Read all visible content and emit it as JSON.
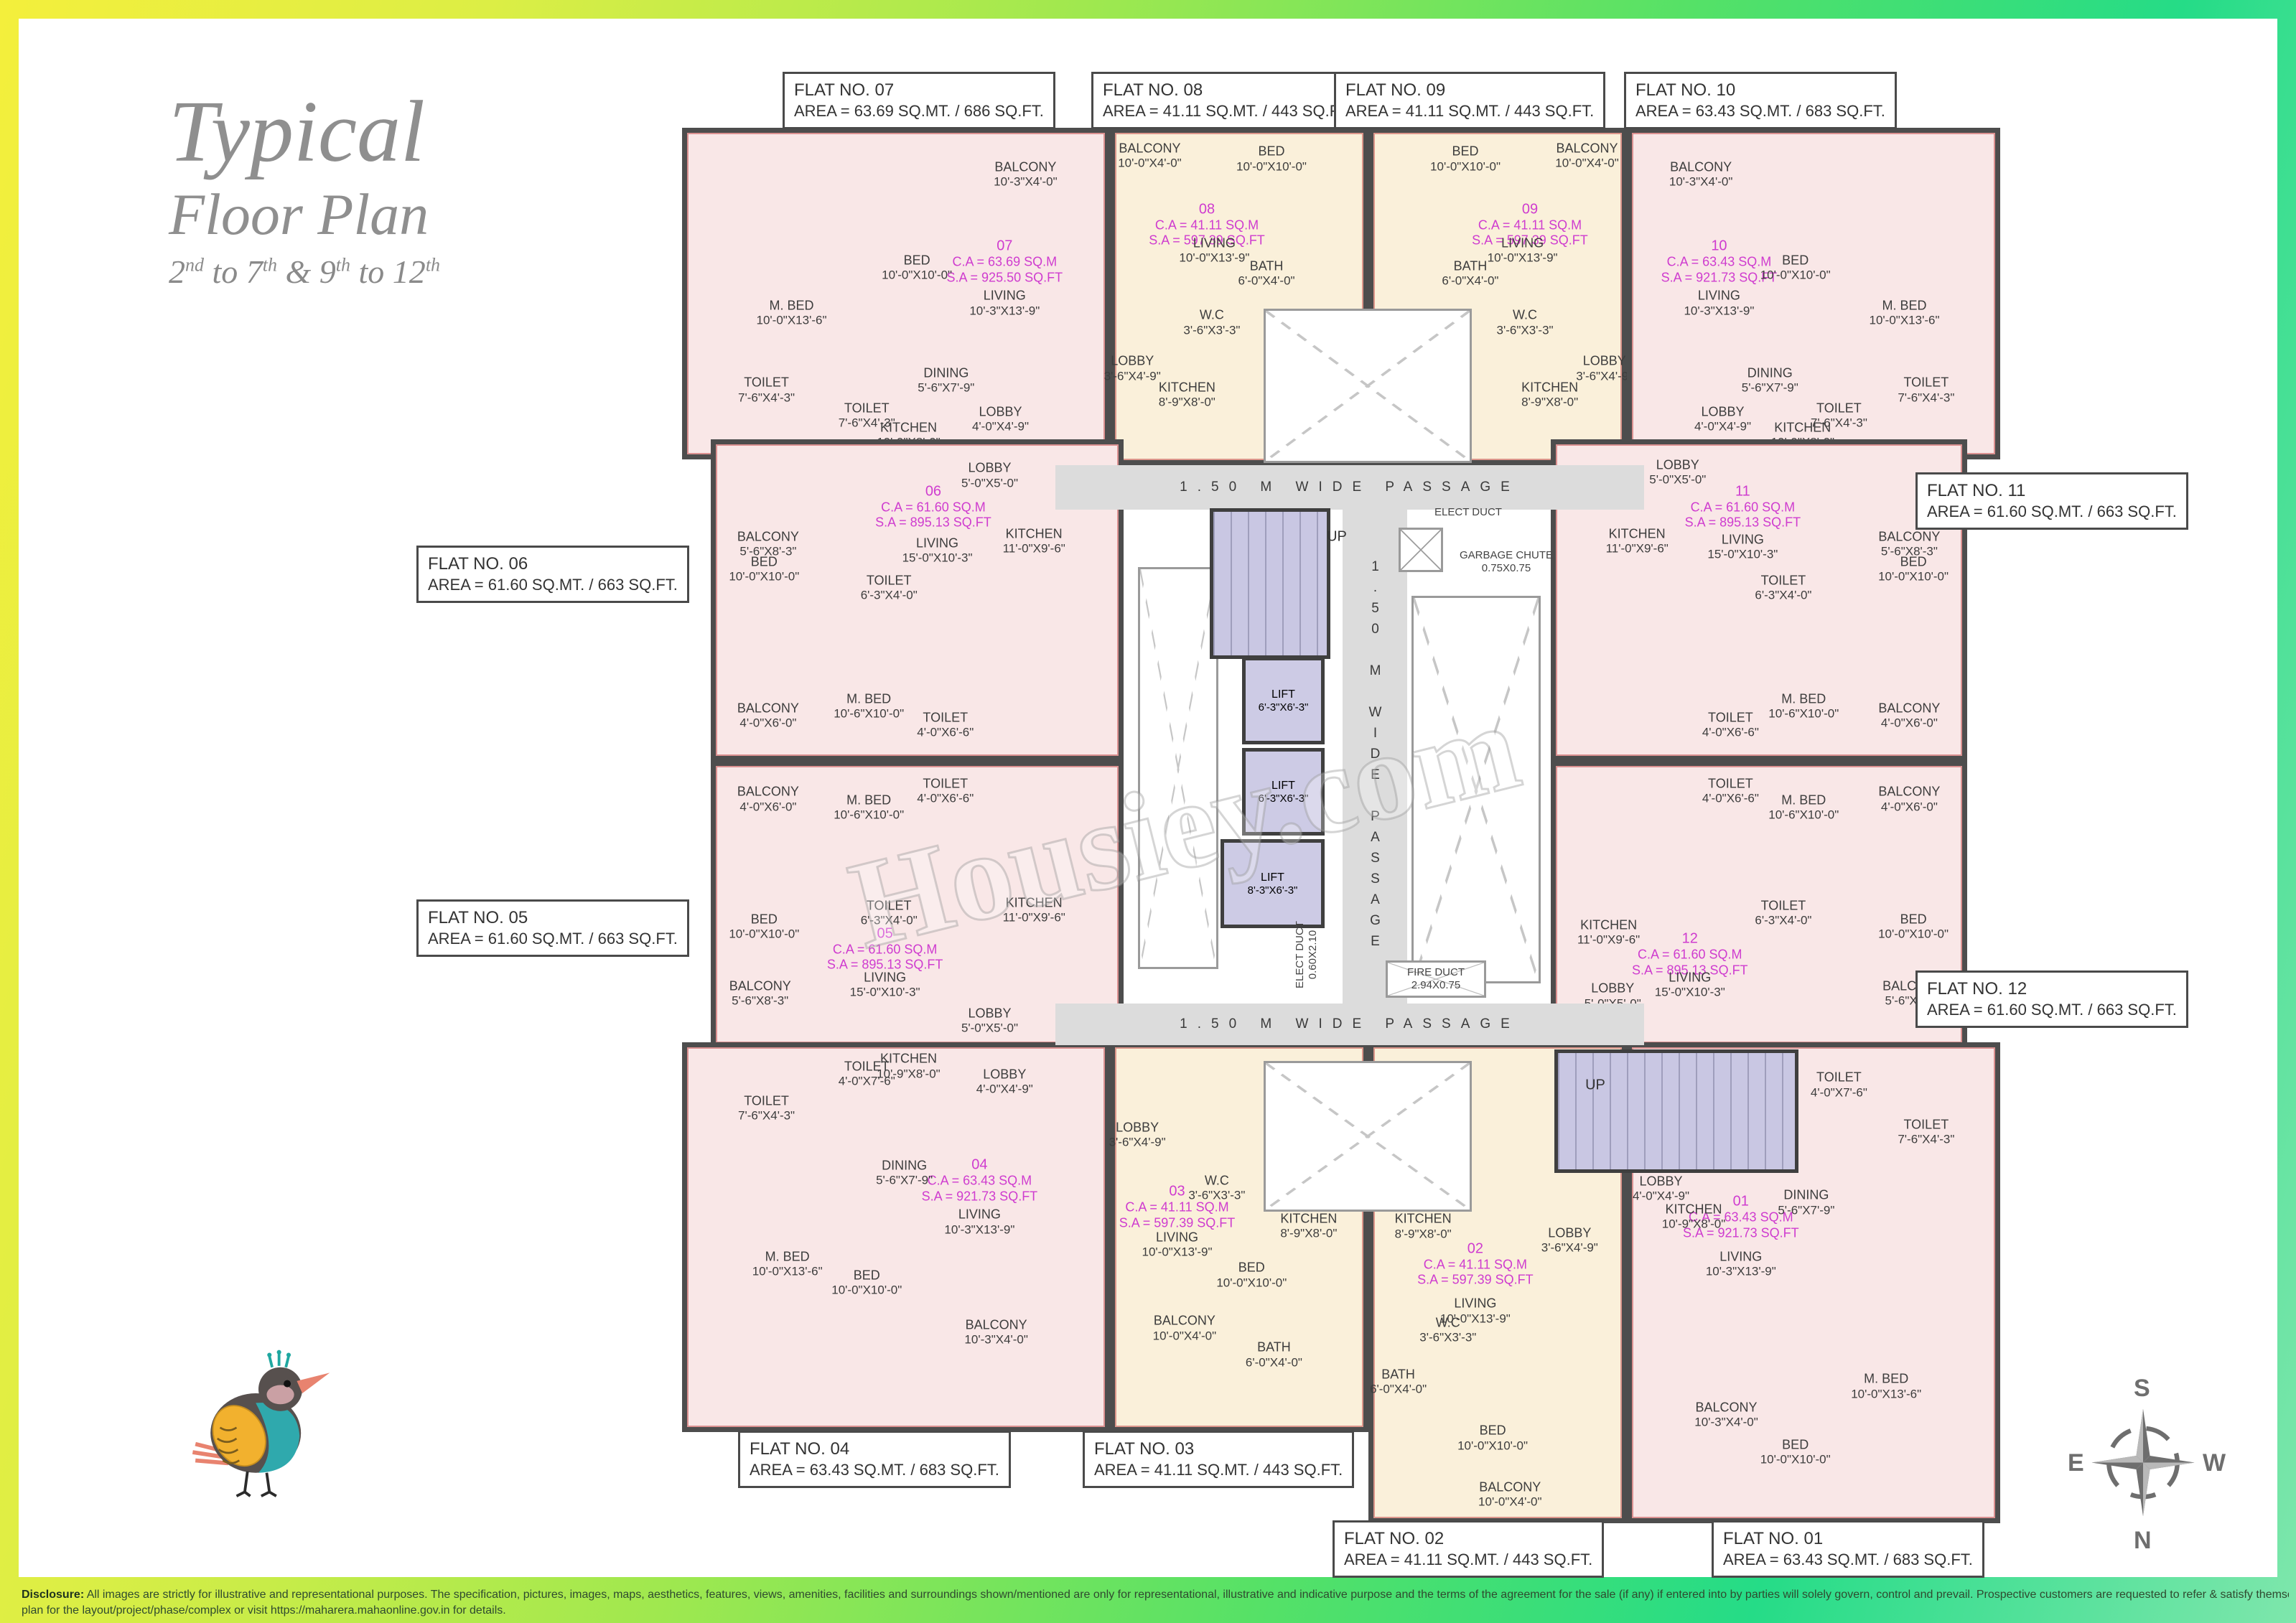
{
  "title": {
    "main": "Typical",
    "sub": "Floor Plan",
    "range_parts": [
      {
        "t": "2"
      },
      {
        "t": "nd",
        "sup": true
      },
      {
        "t": " to 7"
      },
      {
        "t": "th",
        "sup": true
      },
      {
        "t": " & 9"
      },
      {
        "t": "th",
        "sup": true
      },
      {
        "t": " to 12"
      },
      {
        "t": "th",
        "sup": true
      }
    ]
  },
  "watermark": "Housiey.com",
  "flat_boxes": {
    "07": {
      "title": "FLAT NO. 07",
      "area": "AREA = 63.69 SQ.MT. / 686 SQ.FT."
    },
    "08": {
      "title": "FLAT NO. 08",
      "area": "AREA = 41.11 SQ.MT. / 443 SQ.FT."
    },
    "09": {
      "title": "FLAT NO. 09",
      "area": "AREA = 41.11 SQ.MT. / 443 SQ.FT."
    },
    "10": {
      "title": "FLAT NO. 10",
      "area": "AREA = 63.43 SQ.MT. / 683 SQ.FT."
    },
    "06": {
      "title": "FLAT NO. 06",
      "area": "AREA = 61.60 SQ.MT. / 663 SQ.FT."
    },
    "05": {
      "title": "FLAT NO. 05",
      "area": "AREA = 61.60 SQ.MT. / 663 SQ.FT."
    },
    "11": {
      "title": "FLAT NO. 11",
      "area": "AREA = 61.60 SQ.MT. / 663 SQ.FT."
    },
    "12": {
      "title": "FLAT NO. 12",
      "area": "AREA = 61.60 SQ.MT. / 663 SQ.FT."
    },
    "04": {
      "title": "FLAT NO. 04",
      "area": "AREA = 63.43 SQ.MT. / 683 SQ.FT."
    },
    "03": {
      "title": "FLAT NO. 03",
      "area": "AREA = 41.11 SQ.MT. / 443 SQ.FT."
    },
    "02": {
      "title": "FLAT NO. 02",
      "area": "AREA = 41.11 SQ.MT. / 443 SQ.FT."
    },
    "01": {
      "title": "FLAT NO. 01",
      "area": "AREA = 63.43 SQ.MT. / 683 SQ.FT."
    }
  },
  "flats": {
    "07": {
      "ca": "C.A = 63.69 SQ.M",
      "sa": "S.A = 925.50 SQ.FT",
      "rooms": [
        {
          "name": "M. BED",
          "dim": "10'-0\"X13'-6\""
        },
        {
          "name": "BED",
          "dim": "10'-0\"X10'-0\""
        },
        {
          "name": "BALCONY",
          "dim": "10'-3\"X4'-0\""
        },
        {
          "name": "LIVING",
          "dim": "10'-3\"X13'-9\""
        },
        {
          "name": "TOILET",
          "dim": "7'-6\"X4'-3\""
        },
        {
          "name": "TOILET",
          "dim": "7'-6\"X4'-3\""
        },
        {
          "name": "DINING",
          "dim": "5'-6\"X7'-9\""
        },
        {
          "name": "KITCHEN",
          "dim": "10'-9\"X8'-0\""
        },
        {
          "name": "LOBBY",
          "dim": "4'-0\"X4'-9\""
        }
      ]
    },
    "08": {
      "ca": "C.A = 41.11 SQ.M",
      "sa": "S.A = 597.39 SQ.FT",
      "rooms": [
        {
          "name": "BALCONY",
          "dim": "10'-0\"X4'-0\""
        },
        {
          "name": "LIVING",
          "dim": "10'-0\"X13'-9\""
        },
        {
          "name": "BED",
          "dim": "10'-0\"X10'-0\""
        },
        {
          "name": "BATH",
          "dim": "6'-0\"X4'-0\""
        },
        {
          "name": "W.C",
          "dim": "3'-6\"X3'-3\""
        },
        {
          "name": "KITCHEN",
          "dim": "8'-9\"X8'-0\""
        },
        {
          "name": "LOBBY",
          "dim": "3'-6\"X4'-9\""
        }
      ]
    },
    "09": {
      "ca": "C.A = 41.11 SQ.M",
      "sa": "S.A = 597.39 SQ.FT",
      "rooms": [
        {
          "name": "BALCONY",
          "dim": "10'-0\"X4'-0\""
        },
        {
          "name": "LIVING",
          "dim": "10'-0\"X13'-9\""
        },
        {
          "name": "BED",
          "dim": "10'-0\"X10'-0\""
        },
        {
          "name": "BATH",
          "dim": "6'-0\"X4'-0\""
        },
        {
          "name": "W.C",
          "dim": "3'-6\"X3'-3\""
        },
        {
          "name": "KITCHEN",
          "dim": "8'-9\"X8'-0\""
        },
        {
          "name": "LOBBY",
          "dim": "3'-6\"X4'-9\""
        }
      ]
    },
    "10": {
      "ca": "C.A = 63.43 SQ.M",
      "sa": "S.A = 921.73 SQ.FT",
      "rooms": [
        {
          "name": "M. BED",
          "dim": "10'-0\"X13'-6\""
        },
        {
          "name": "BED",
          "dim": "10'-0\"X10'-0\""
        },
        {
          "name": "BALCONY",
          "dim": "10'-3\"X4'-0\""
        },
        {
          "name": "LIVING",
          "dim": "10'-3\"X13'-9\""
        },
        {
          "name": "TOILET",
          "dim": "7'-6\"X4'-3\""
        },
        {
          "name": "TOILET",
          "dim": "7'-6\"X4'-3\""
        },
        {
          "name": "DINING",
          "dim": "5'-6\"X7'-9\""
        },
        {
          "name": "KITCHEN",
          "dim": "10'-9\"X8'-0\""
        },
        {
          "name": "LOBBY",
          "dim": "4'-0\"X4'-9\""
        }
      ]
    },
    "06": {
      "ca": "C.A = 61.60 SQ.M",
      "sa": "S.A = 895.13 SQ.FT",
      "rooms": [
        {
          "name": "BALCONY",
          "dim": "5'-6\"X8'-3\""
        },
        {
          "name": "LIVING",
          "dim": "15'-0\"X10'-3\""
        },
        {
          "name": "LOBBY",
          "dim": "5'-0\"X5'-0\""
        },
        {
          "name": "BED",
          "dim": "10'-0\"X10'-0\""
        },
        {
          "name": "TOILET",
          "dim": "6'-3\"X4'-0\""
        },
        {
          "name": "M. BED",
          "dim": "10'-6\"X10'-0\""
        },
        {
          "name": "BALCONY",
          "dim": "4'-0\"X6'-0\""
        },
        {
          "name": "TOILET",
          "dim": "4'-0\"X6'-6\""
        },
        {
          "name": "KITCHEN",
          "dim": "11'-0\"X9'-6\""
        }
      ]
    },
    "05": {
      "ca": "C.A = 61.60 SQ.M",
      "sa": "S.A = 895.13 SQ.FT",
      "rooms": [
        {
          "name": "BALCONY",
          "dim": "5'-6\"X8'-3\""
        },
        {
          "name": "LIVING",
          "dim": "15'-0\"X10'-3\""
        },
        {
          "name": "LOBBY",
          "dim": "5'-0\"X5'-0\""
        },
        {
          "name": "BED",
          "dim": "10'-0\"X10'-0\""
        },
        {
          "name": "TOILET",
          "dim": "6'-3\"X4'-0\""
        },
        {
          "name": "M. BED",
          "dim": "10'-6\"X10'-0\""
        },
        {
          "name": "BALCONY",
          "dim": "4'-0\"X6'-0\""
        },
        {
          "name": "TOILET",
          "dim": "4'-0\"X6'-6\""
        },
        {
          "name": "KITCHEN",
          "dim": "11'-0\"X9'-6\""
        }
      ]
    },
    "11": {
      "ca": "C.A = 61.60 SQ.M",
      "sa": "S.A = 895.13 SQ.FT",
      "rooms": [
        {
          "name": "BALCONY",
          "dim": "5'-6\"X8'-3\""
        },
        {
          "name": "LIVING",
          "dim": "15'-0\"X10'-3\""
        },
        {
          "name": "LOBBY",
          "dim": "5'-0\"X5'-0\""
        },
        {
          "name": "BED",
          "dim": "10'-0\"X10'-0\""
        },
        {
          "name": "TOILET",
          "dim": "6'-3\"X4'-0\""
        },
        {
          "name": "M. BED",
          "dim": "10'-6\"X10'-0\""
        },
        {
          "name": "BALCONY",
          "dim": "4'-0\"X6'-0\""
        },
        {
          "name": "TOILET",
          "dim": "4'-0\"X6'-6\""
        },
        {
          "name": "KITCHEN",
          "dim": "11'-0\"X9'-6\""
        }
      ]
    },
    "12": {
      "ca": "C.A = 61.60 SQ.M",
      "sa": "S.A = 895.13 SQ.FT",
      "rooms": [
        {
          "name": "BALCONY",
          "dim": "5'-6\"X8'-3\""
        },
        {
          "name": "LIVING",
          "dim": "15'-0\"X10'-3\""
        },
        {
          "name": "LOBBY",
          "dim": "5'-0\"X5'-0\""
        },
        {
          "name": "BED",
          "dim": "10'-0\"X10'-0\""
        },
        {
          "name": "TOILET",
          "dim": "6'-3\"X4'-0\""
        },
        {
          "name": "M. BED",
          "dim": "10'-6\"X10'-0\""
        },
        {
          "name": "BALCONY",
          "dim": "4'-0\"X6'-0\""
        },
        {
          "name": "TOILET",
          "dim": "4'-0\"X6'-6\""
        },
        {
          "name": "KITCHEN",
          "dim": "11'-0\"X9'-6\""
        }
      ]
    },
    "04": {
      "ca": "C.A = 63.43 SQ.M",
      "sa": "S.A = 921.73 SQ.FT",
      "rooms": [
        {
          "name": "M. BED",
          "dim": "10'-0\"X13'-6\""
        },
        {
          "name": "BED",
          "dim": "10'-0\"X10'-0\""
        },
        {
          "name": "BALCONY",
          "dim": "10'-3\"X4'-0\""
        },
        {
          "name": "LIVING",
          "dim": "10'-3\"X13'-9\""
        },
        {
          "name": "TOILET",
          "dim": "7'-6\"X4'-3\""
        },
        {
          "name": "TOILET",
          "dim": "4'-0\"X7'-6\""
        },
        {
          "name": "DINING",
          "dim": "5'-6\"X7'-9\""
        },
        {
          "name": "KITCHEN",
          "dim": "10'-9\"X8'-0\""
        },
        {
          "name": "LOBBY",
          "dim": "4'-0\"X4'-9\""
        }
      ]
    },
    "03": {
      "ca": "C.A = 41.11 SQ.M",
      "sa": "S.A = 597.39 SQ.FT",
      "rooms": [
        {
          "name": "BALCONY",
          "dim": "10'-0\"X4'-0\""
        },
        {
          "name": "LIVING",
          "dim": "10'-0\"X13'-9\""
        },
        {
          "name": "BED",
          "dim": "10'-0\"X10'-0\""
        },
        {
          "name": "BATH",
          "dim": "6'-0\"X4'-0\""
        },
        {
          "name": "W.C",
          "dim": "3'-6\"X3'-3\""
        },
        {
          "name": "KITCHEN",
          "dim": "8'-9\"X8'-0\""
        },
        {
          "name": "LOBBY",
          "dim": "3'-6\"X4'-9\""
        }
      ]
    },
    "02": {
      "ca": "C.A = 41.11 SQ.M",
      "sa": "S.A = 597.39 SQ.FT",
      "rooms": [
        {
          "name": "BALCONY",
          "dim": "10'-0\"X4'-0\""
        },
        {
          "name": "LIVING",
          "dim": "10'-0\"X13'-9\""
        },
        {
          "name": "BED",
          "dim": "10'-0\"X10'-0\""
        },
        {
          "name": "BATH",
          "dim": "6'-0\"X4'-0\""
        },
        {
          "name": "W.C",
          "dim": "3'-6\"X3'-3\""
        },
        {
          "name": "KITCHEN",
          "dim": "8'-9\"X8'-0\""
        },
        {
          "name": "LOBBY",
          "dim": "3'-6\"X4'-9\""
        }
      ]
    },
    "01": {
      "ca": "C.A = 63.43 SQ.M",
      "sa": "S.A = 921.73 SQ.FT",
      "rooms": [
        {
          "name": "M. BED",
          "dim": "10'-0\"X13'-6\""
        },
        {
          "name": "BED",
          "dim": "10'-0\"X10'-0\""
        },
        {
          "name": "BALCONY",
          "dim": "10'-3\"X4'-0\""
        },
        {
          "name": "LIVING",
          "dim": "10'-3\"X13'-9\""
        },
        {
          "name": "TOILET",
          "dim": "7'-6\"X4'-3\""
        },
        {
          "name": "TOILET",
          "dim": "4'-0\"X7'-6\""
        },
        {
          "name": "DINING",
          "dim": "5'-6\"X7'-9\""
        },
        {
          "name": "KITCHEN",
          "dim": "10'-9\"X8'-0\""
        },
        {
          "name": "LOBBY",
          "dim": "4'-0\"X4'-9\""
        }
      ]
    }
  },
  "core": {
    "passage_top": "1.50 M WIDE PASSAGE",
    "passage_vertical": "1.50 M WIDE PASSAGE",
    "passage_bottom": "1.50 M WIDE PASSAGE",
    "up_top": "UP",
    "up_bottom": "UP",
    "lifts": [
      {
        "name": "LIFT",
        "dim": "6'-3\"X6'-3\""
      },
      {
        "name": "LIFT",
        "dim": "6'-3\"X6'-3\""
      },
      {
        "name": "LIFT",
        "dim": "8'-3\"X6'-3\""
      }
    ],
    "elect_duct_top": "ELECT DUCT",
    "garbage_chute": {
      "name": "GARBAGE CHUTE",
      "dim": "0.75X0.75"
    },
    "elect_duct_side": {
      "name": "ELECT DUCT",
      "dim": "0.60X2.10"
    },
    "fire_duct": {
      "name": "FIRE DUCT",
      "dim": "2.94X0.75"
    }
  },
  "compass": {
    "top": "S",
    "bottom": "N",
    "left": "E",
    "right": "W"
  },
  "disclaimer": {
    "prefix": "Disclosure:",
    "line1": " All images are strictly for illustrative and representational purposes. The specification, pictures, images, maps, aesthetics, features, views, amenities, facilities and surroundings shown/mentioned are only for representational, illustrative and indicative purpose and the terms of the agreement for the sale (if any) if entered into by parties will solely govern, control and prevail. Prospective customers are requested to refer & satisfy themselves with respect to the sanctioned",
    "line2": "plan for the layout/project/phase/complex or visit https://maharera.mahaonline.gov.in for details."
  },
  "colors": {
    "flat_pink": "#f9e7e7",
    "flat_cream": "#faf0da",
    "wall": "#4d4d4d",
    "passage_gray": "#dcdcdc",
    "stair_lavender": "#c9c7e3",
    "unit_magenta": "#cf3ccf",
    "frame_yellow": "#f4ef3c",
    "frame_green": "#25dc87"
  }
}
